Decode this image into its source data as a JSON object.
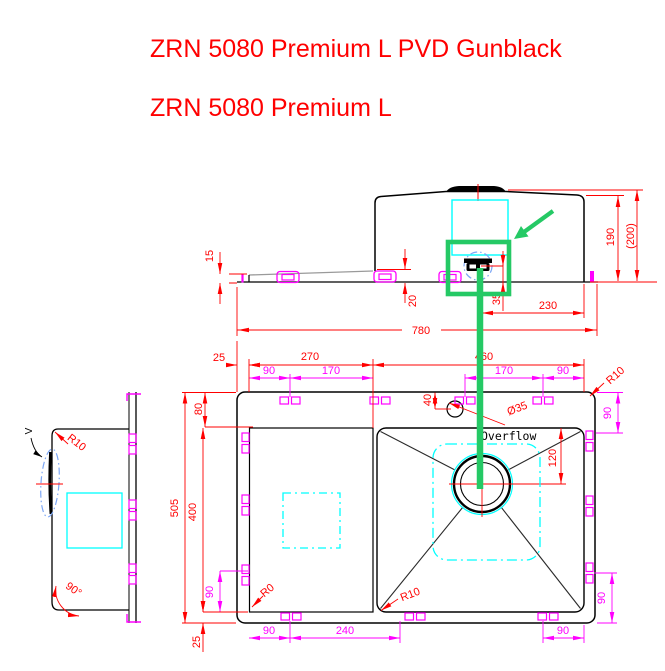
{
  "titles": {
    "line1": "ZRN 5080 Premium L PVD Gunblack",
    "line2": "ZRN 5080 Premium L"
  },
  "colors": {
    "title_red": "#ff0000",
    "dimension_red": "#ff0000",
    "accessory_magenta": "#ff00ff",
    "template_cyan": "#00ffff",
    "highlight_green": "#25c965",
    "hidden_detail_blue": "#7da7f5",
    "outline_black": "#000000"
  },
  "front": {
    "d15": "15",
    "d20": "20",
    "d35": "35",
    "d230": "230",
    "d780": "780",
    "d190": "190",
    "d200": "(200)"
  },
  "plan": {
    "d25_top": "25",
    "d270": "270",
    "d460": "460",
    "d90_tl": "90",
    "d170_l": "170",
    "d170_r": "170",
    "d90_tr": "90",
    "d40": "40",
    "dia35": "Ø35",
    "r10_corner": "R10",
    "d90_right_top": "90",
    "d80": "80",
    "d505": "505",
    "d400": "400",
    "d90_left_bot": "90",
    "d25_bottom": "25",
    "d90_bl": "90",
    "d240": "240",
    "d90_br": "90",
    "d90_right_bot": "90",
    "d120": "120",
    "overflow": "Overflow",
    "r10_bowl": "R10",
    "r0": "R0"
  },
  "profile": {
    "v_mark": "V",
    "r10": "R10",
    "angle": "90°"
  }
}
